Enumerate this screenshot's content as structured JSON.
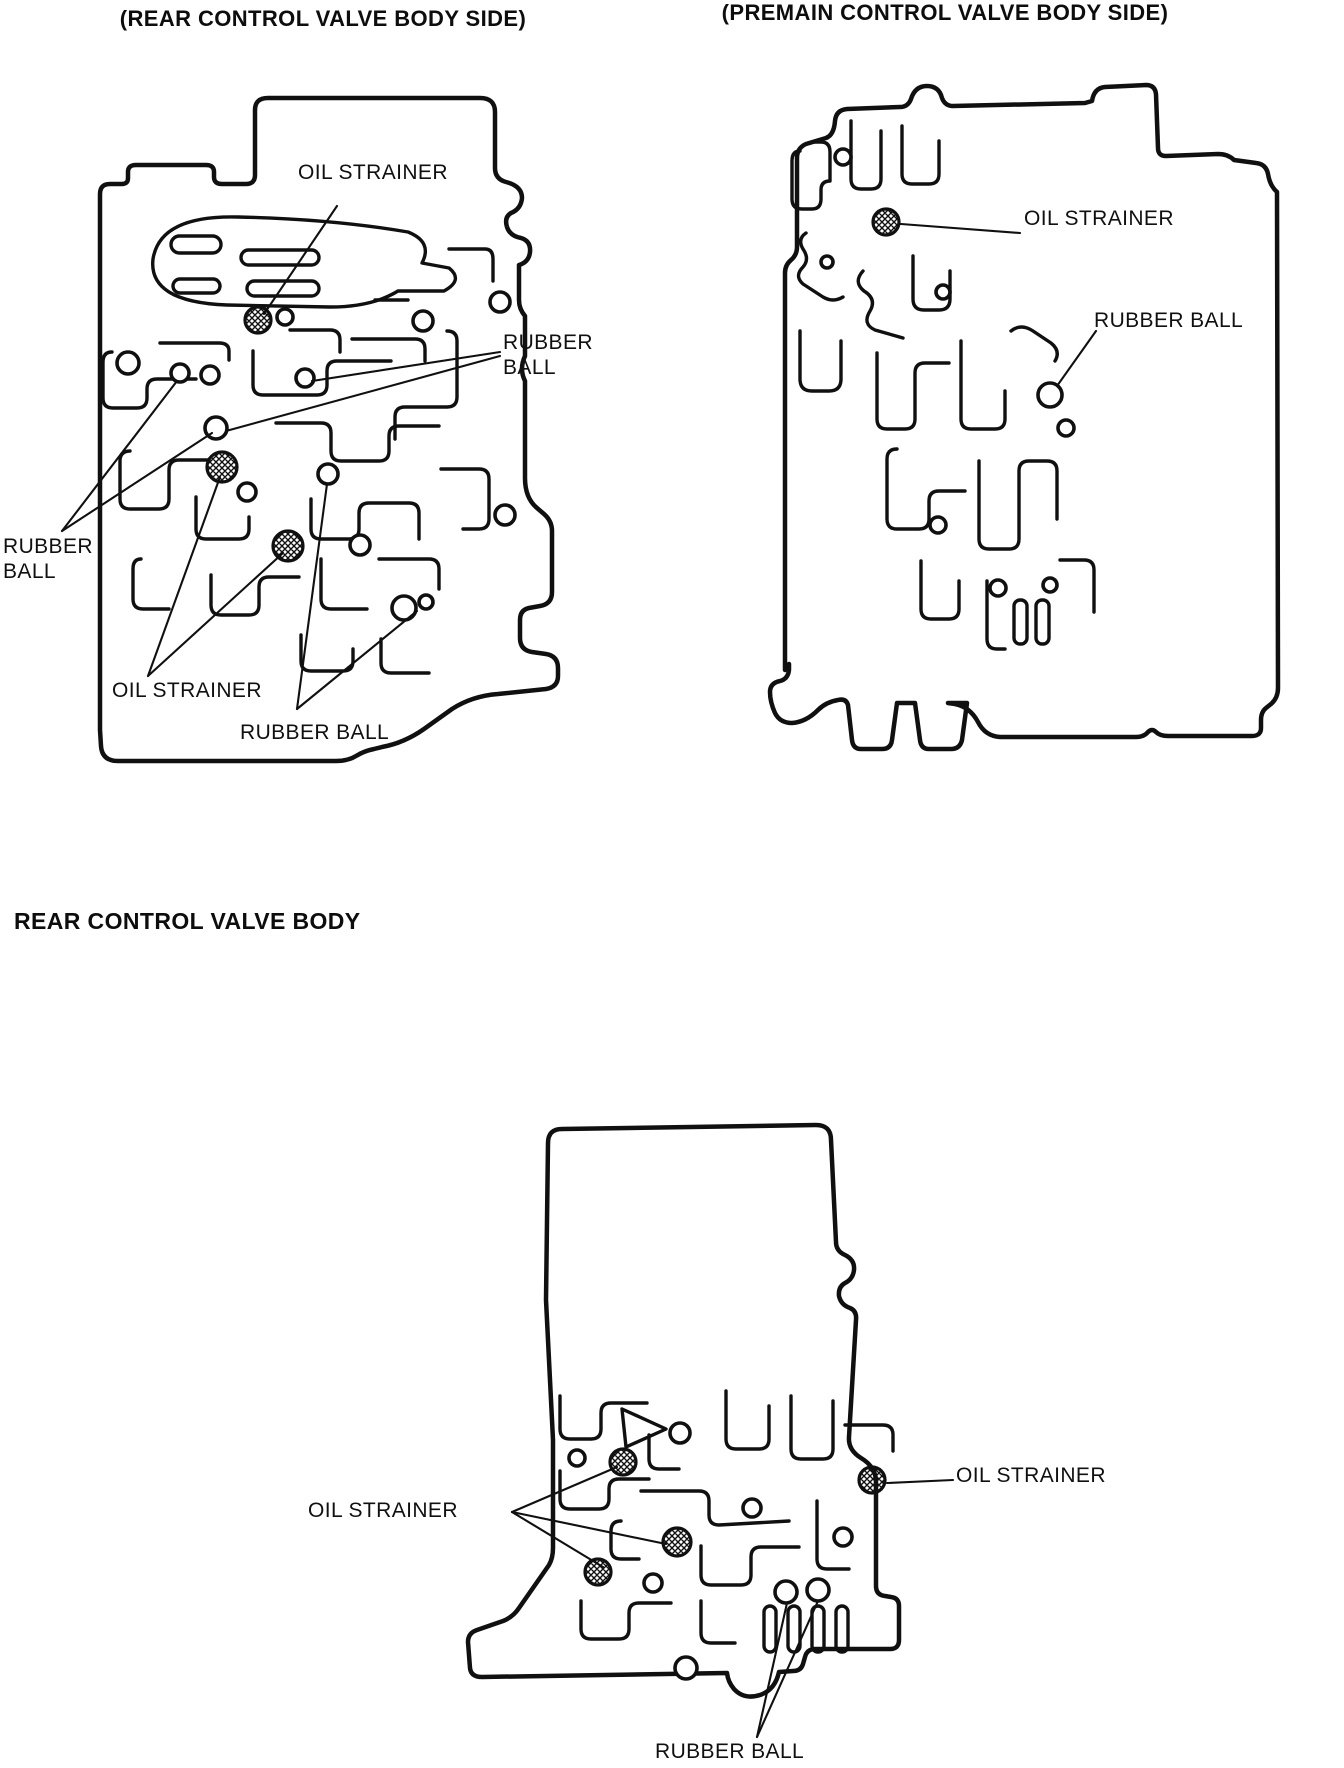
{
  "colors": {
    "ink": "#101010",
    "paper": "#ffffff"
  },
  "header": {
    "left_title": "(REAR CONTROL VALVE BODY SIDE)",
    "right_title": "(PREMAIN CONTROL VALVE BODY SIDE)"
  },
  "section_heading": "REAR CONTROL VALVE BODY",
  "legend": {
    "oil_strainer_marker": "crosshatched-circle",
    "rubber_ball_marker": "open-circle"
  },
  "rear_side_view": {
    "title_ref": "left_title",
    "labels": {
      "oil_strainer_top": "OIL STRAINER",
      "rubber_ball_right": "RUBBER BALL",
      "rubber_ball_left": "RUBBER BALL",
      "oil_strainer_bottom": "OIL STRAINER",
      "rubber_ball_bottom": "RUBBER BALL"
    },
    "marker_counts": {
      "oil_strainers": 3,
      "rubber_balls_called_out": 6
    }
  },
  "premain_side_view": {
    "title_ref": "right_title",
    "labels": {
      "oil_strainer": "OIL STRAINER",
      "rubber_ball": "RUBBER BALL"
    },
    "marker_counts": {
      "oil_strainers": 1,
      "rubber_balls_called_out": 1
    }
  },
  "rear_body_view": {
    "labels": {
      "oil_strainer_left": "OIL STRAINER",
      "oil_strainer_right": "OIL STRAINER",
      "rubber_ball_bottom": "RUBBER BALL"
    },
    "marker_counts": {
      "oil_strainers": 4,
      "rubber_balls_called_out": 2
    }
  }
}
